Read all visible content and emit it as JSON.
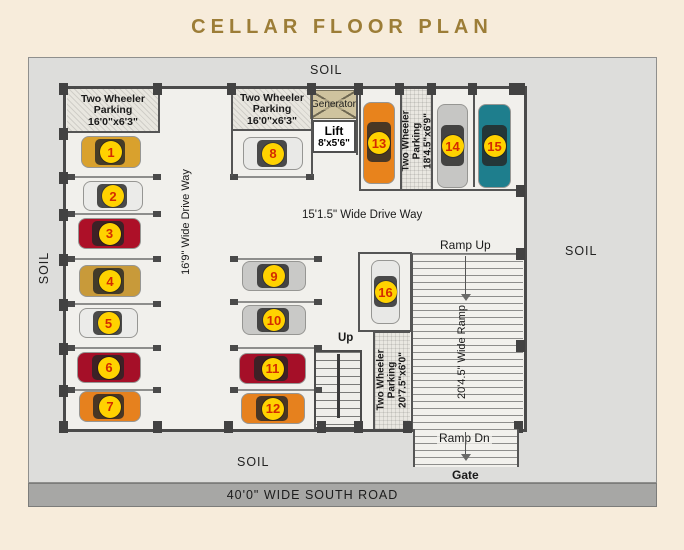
{
  "title": "CELLAR FLOOR PLAN",
  "colors": {
    "accent": "#9c7d37",
    "badge_bg": "#ffd200",
    "badge_text": "#d42b00",
    "site_bg": "#dddddb",
    "road_bg": "#a7a7a5"
  },
  "site": {
    "soil_top": "SOIL",
    "soil_left": "SOIL",
    "soil_right": "SOIL",
    "soil_bottom": "SOIL",
    "road": "40'0\" WIDE SOUTH ROAD"
  },
  "areas": {
    "parking_top_left": {
      "l1": "Two Wheeler",
      "l2": "Parking",
      "dim": "16'0\"x6'3\""
    },
    "parking_top_mid": {
      "l1": "Two Wheeler",
      "l2": "Parking",
      "dim": "16'0\"x6'3\""
    },
    "parking_right": {
      "l1": "Two Wheeler",
      "l2": "Parking",
      "dim": "18'4.5\"x6'9\""
    },
    "parking_bottom": {
      "l1": "Two Wheeler",
      "l2": "Parking",
      "dim": "20'7.5\"x6'0\""
    },
    "driveway_vertical": "16'9\" Wide Drive Way",
    "driveway_horizontal": "15'1.5\" Wide Drive Way",
    "generator": "Generator",
    "lift": {
      "name": "Lift",
      "dim": "8'x5'6\""
    },
    "stairs_up": "Up",
    "ramp": {
      "up": "Ramp Up",
      "down": "Ramp Dn",
      "width_label": "20'4.5\" Wide Ramp",
      "gate": "Gate"
    }
  },
  "cars": [
    {
      "no": "1",
      "color": "#d9a12d",
      "o": "h",
      "x": 82,
      "y": 137,
      "w": 58,
      "h": 30
    },
    {
      "no": "2",
      "color": "#ebebe9",
      "o": "h",
      "x": 84,
      "y": 182,
      "w": 58,
      "h": 28
    },
    {
      "no": "3",
      "color": "#ad1028",
      "o": "h",
      "x": 79,
      "y": 219,
      "w": 61,
      "h": 29
    },
    {
      "no": "4",
      "color": "#c89a3a",
      "o": "h",
      "x": 80,
      "y": 266,
      "w": 60,
      "h": 30
    },
    {
      "no": "5",
      "color": "#ebebe9",
      "o": "h",
      "x": 80,
      "y": 309,
      "w": 57,
      "h": 28
    },
    {
      "no": "6",
      "color": "#a50f28",
      "o": "h",
      "x": 78,
      "y": 353,
      "w": 62,
      "h": 29
    },
    {
      "no": "7",
      "color": "#e6811e",
      "o": "h",
      "x": 80,
      "y": 392,
      "w": 60,
      "h": 29
    },
    {
      "no": "8",
      "color": "#e9e9e7",
      "o": "h",
      "x": 244,
      "y": 138,
      "w": 58,
      "h": 31
    },
    {
      "no": "9",
      "color": "#c9c9c7",
      "o": "h",
      "x": 243,
      "y": 262,
      "w": 62,
      "h": 28
    },
    {
      "no": "10",
      "color": "#c9c9c7",
      "o": "h",
      "x": 243,
      "y": 306,
      "w": 62,
      "h": 28
    },
    {
      "no": "11",
      "color": "#a50f28",
      "o": "h",
      "x": 240,
      "y": 354,
      "w": 65,
      "h": 29
    },
    {
      "no": "12",
      "color": "#e6811e",
      "o": "h",
      "x": 242,
      "y": 394,
      "w": 62,
      "h": 29
    },
    {
      "no": "13",
      "color": "#e8831c",
      "o": "v",
      "x": 364,
      "y": 103,
      "w": 30,
      "h": 80
    },
    {
      "no": "14",
      "color": "#c6c6c4",
      "o": "v",
      "x": 438,
      "y": 105,
      "w": 29,
      "h": 82
    },
    {
      "no": "15",
      "color": "#1e7e8d",
      "o": "v",
      "x": 479,
      "y": 105,
      "w": 31,
      "h": 82
    },
    {
      "no": "16",
      "color": "#e8e8e6",
      "o": "v",
      "x": 372,
      "y": 261,
      "w": 27,
      "h": 62
    }
  ]
}
